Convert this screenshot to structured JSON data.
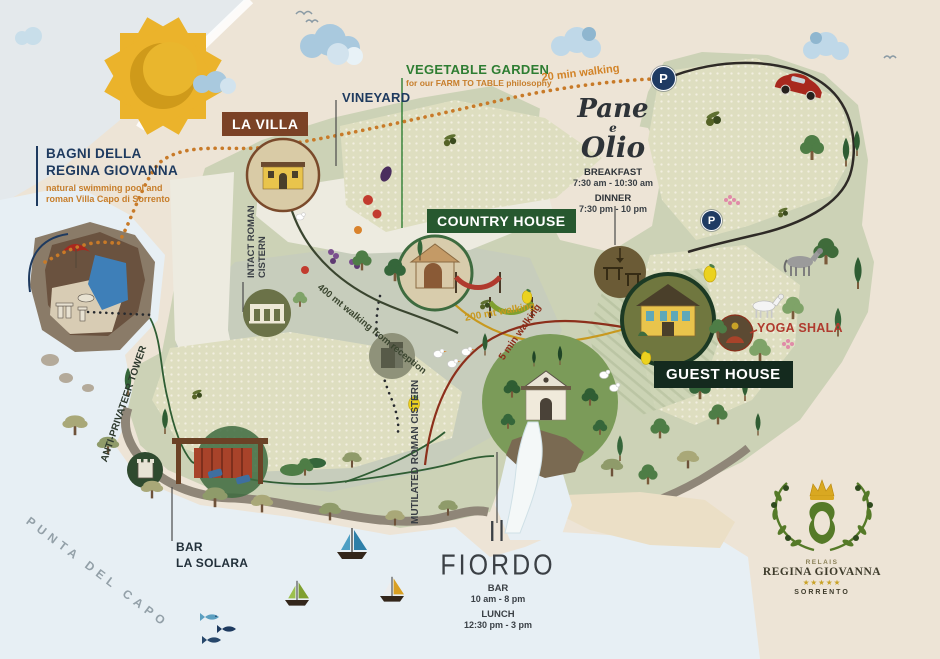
{
  "title": "Relais Regina Giovanna estate map",
  "colors": {
    "background": "#EDE4D6",
    "sea": "#E7EFF4",
    "navy_text": "#1E3A5F",
    "orange_text": "#C77E2B",
    "green_label": "#2E7D32",
    "brown_badge": "#7B4226",
    "green_badge": "#27582F",
    "dark_green_badge": "#142A1E",
    "red_label": "#B03A2E",
    "gold_path": "#C8991F",
    "dark_red_path": "#8C2F1B",
    "parking_blue": "#1F3B63",
    "logo_green": "#557A28",
    "logo_gold": "#C9A227"
  },
  "locations": {
    "bagni": {
      "title": "BAGNI DELLA\nREGINA GIOVANNA",
      "subtitle": "natural swimming pool and\nroman Villa Capo di Sorrento"
    },
    "la_villa": {
      "label": "LA VILLA"
    },
    "vineyard": {
      "label": "VINEYARD"
    },
    "vegetable_garden": {
      "label": "VEGETABLE GARDEN",
      "subtitle": "for our FARM TO TABLE philosophy"
    },
    "country_house": {
      "label": "COUNTRY HOUSE"
    },
    "pane_e_olio": {
      "name_line1": "Pane",
      "name_line2": "e",
      "name_line3": "Olio",
      "breakfast_label": "BREAKFAST",
      "breakfast_hours": "7:30 am - 10:30 am",
      "dinner_label": "DINNER",
      "dinner_hours": "7:30 pm - 10 pm"
    },
    "guest_house": {
      "label": "GUEST HOUSE"
    },
    "yoga_shala": {
      "label": "YOGA SHALA"
    },
    "il_fiordo": {
      "name": "Il FIORDO",
      "bar_label": "BAR",
      "bar_hours": "10 am - 8 pm",
      "lunch_label": "LUNCH",
      "lunch_hours": "12:30 pm - 3 pm"
    },
    "bar_la_solara": {
      "label": "BAR\nLA SOLARA"
    },
    "intact_cistern": {
      "label": "INTACT ROMAN CISTERN"
    },
    "mutilated_cistern": {
      "label": "MUTILATED ROMAN CISTERN"
    },
    "anti_privateer_tower": {
      "label": "ANTI-PRIVATEER TOWER"
    },
    "punta_del_capo": {
      "label": "PUNTA DEL CAPO"
    }
  },
  "routes": {
    "walk_20min": "20 min walking",
    "walk_400mt": "400 mt walking from reception",
    "walk_200mt": "200 mt walking",
    "walk_5min": "5 min walking"
  },
  "parking": {
    "symbol": "P"
  },
  "logo": {
    "relais": "RELAIS",
    "name": "REGINA GIOVANNA",
    "stars": "★★★★★",
    "city": "SORRENTO"
  }
}
